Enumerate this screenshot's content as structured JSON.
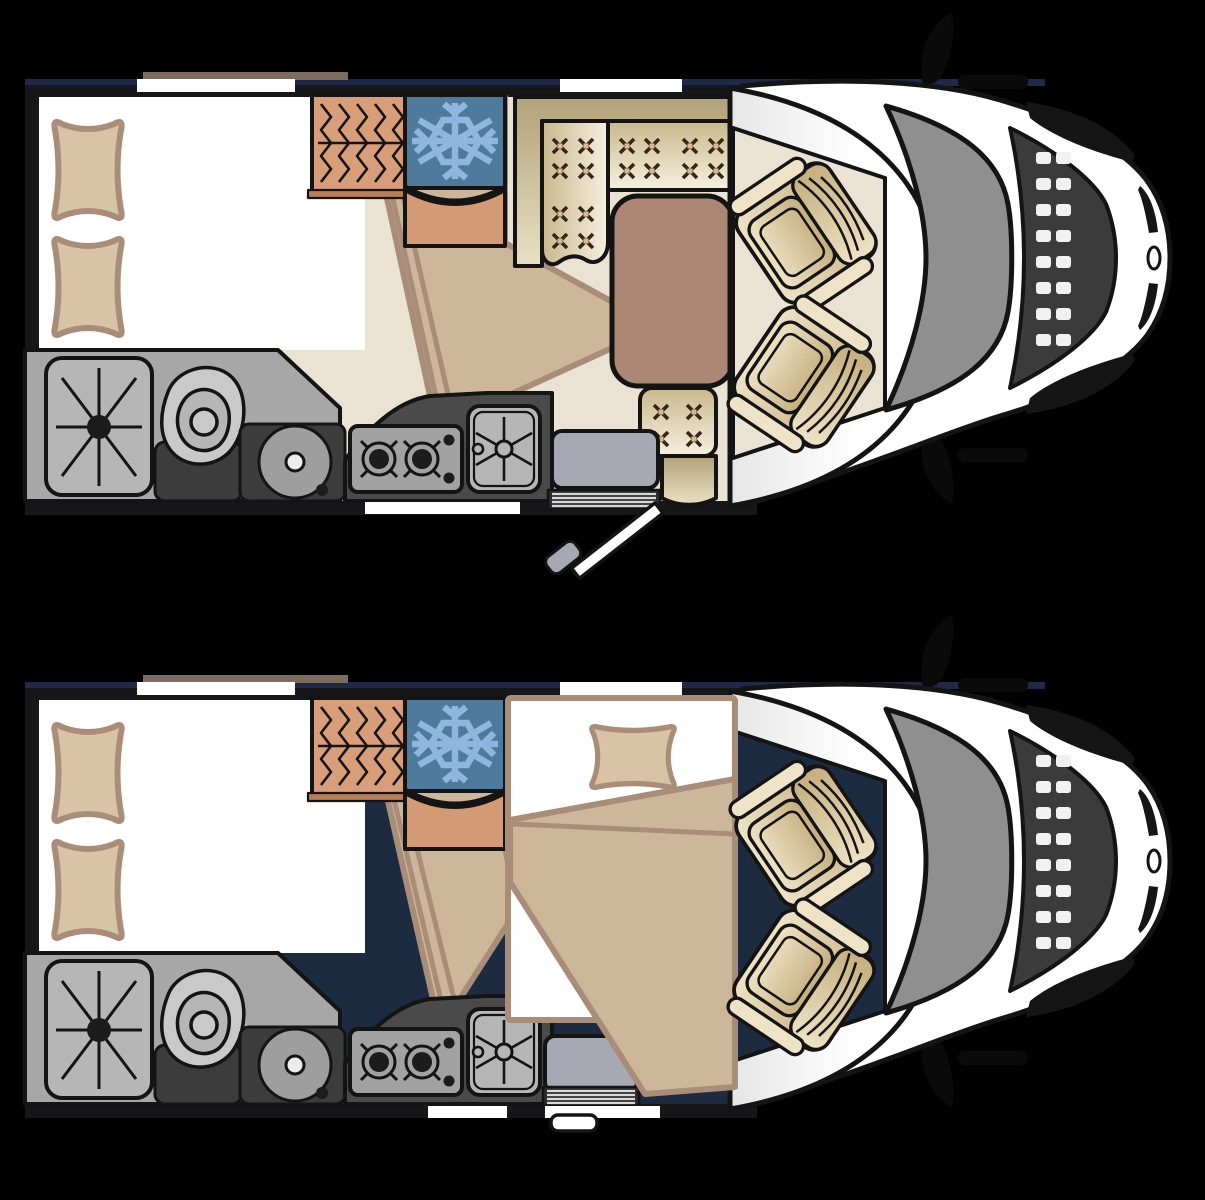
{
  "meta": {
    "title": "Motorhome floor plan — day and night layouts",
    "canvas": {
      "width": 1205,
      "height": 1200
    }
  },
  "colors": {
    "bg": "#000000",
    "ink": "#141414",
    "wall": "#17171a",
    "wall_accent": "#20284a",
    "roof_strip": "#7d6c5d",
    "floor_day": "#eae3d3",
    "floor_night": "#1c2b40",
    "window_white": "#ffffff",
    "sheet": "#ffffff",
    "pillow_fill": "#d9c3a6",
    "linen": "#a98d78",
    "duvet": "#cdb79a",
    "wardrobe": "#d89d79",
    "wardrobe_shelf": "#b97e58",
    "fridge": "#4e7a9c",
    "snowflake": "#8fb6de",
    "counter_salmon": "#d49a76",
    "bench_light": "#f6f0df",
    "bench_dark": "#c9b88c",
    "backrest_dark": "#b3a278",
    "backrest_light": "#e9e0c4",
    "tuft": "#332619",
    "tuft_center": "#d9b98a",
    "table": "#ac8775",
    "seat_light": "#eee3c6",
    "seat_dark": "#c5ae7e",
    "bath_floor": "#a7a7a7",
    "bath_dark": "#3c3c3c",
    "fixture_light": "#c9c9c9",
    "fixture_mid": "#b6b6b6",
    "wheel": "#9e9e9e",
    "wheel_hub": "#ededed",
    "counter_dark": "#4a4a4a",
    "hob_plate": "#a2a2a2",
    "burner": "#1c1c1c",
    "step_gray": "#a6a8b4",
    "louver_dark": "#2e2e2e",
    "louver_line": "#d8d8d8",
    "cab_white": "#ffffff",
    "cab_shade": "#e6e6e6",
    "windshield": "#8f8f8f",
    "hood": "#3b3b3b",
    "grille": "#f1f1f1",
    "lamp": "#151515",
    "mirror": "#0a0a0a"
  },
  "plans": [
    {
      "id": "day",
      "name": "day-layout",
      "floor_color_key": "floor_day",
      "entry_door": "open",
      "lounge": "L-shaped tufted dinette with table and two swivel cab seats",
      "rear_bed": "double bed with two pillows and folded duvet"
    },
    {
      "id": "night",
      "name": "night-layout",
      "floor_color_key": "floor_night",
      "entry_door": "closed",
      "lounge": "dinette converted to a made-up bed with one pillow and blanket",
      "rear_bed": "double bed with two pillows and folded duvet"
    }
  ],
  "components": {
    "rear_bed": {
      "label": "double-bed",
      "pillows": 2
    },
    "wardrobe": {
      "label": "wardrobe",
      "icon": "clothes-hanger-springs-icon",
      "hangers": 5
    },
    "fridge": {
      "label": "refrigerator",
      "icon": "snowflake-icon"
    },
    "bathroom": {
      "shower": "shower-tray",
      "toilet": "swivel-toilet",
      "wheel_arch": "wheel-arch"
    },
    "kitchen": {
      "hob": {
        "label": "gas-hob",
        "burners": 2
      },
      "sink": {
        "label": "kitchen-sink"
      }
    },
    "dinette": {
      "benches": 3,
      "tufted_buttons": [
        8,
        8,
        4
      ],
      "table": "dining-table"
    },
    "converted_bed": {
      "label": "dinette-bed",
      "pillows": 1
    },
    "cab": {
      "label": "driver-cab",
      "swivel_seats": 2,
      "mirrors": 2,
      "windshield": true,
      "grille_slats": 16
    },
    "windows": {
      "top_wall": 2,
      "bottom_wall": 1
    }
  }
}
